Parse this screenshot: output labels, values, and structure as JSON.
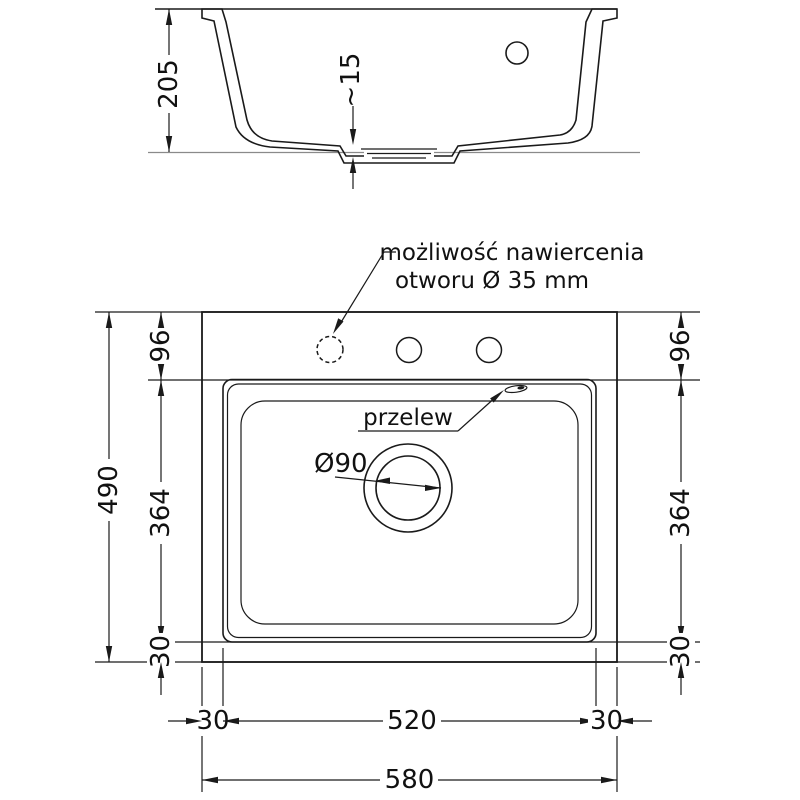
{
  "title": "sink technical drawing",
  "side_view": {
    "total_height": "205",
    "drain_depth": "~15"
  },
  "plan_view": {
    "note_line1": "możliwość nawiercenia",
    "note_line2": "otworu Ø 35 mm",
    "overflow_label": "przelew",
    "drain_diameter": "Ø90",
    "rim_offset_left": "96",
    "rim_offset_right": "96",
    "bowl_length_left": "364",
    "bowl_length_right": "364",
    "bottom_offset_left": "30",
    "bottom_offset_right": "30",
    "overall_depth": "490",
    "margin_left": "30",
    "bowl_width": "520",
    "margin_right": "30",
    "overall_width": "580"
  },
  "colors": {
    "line": "#1a1a1a",
    "background": "#ffffff"
  }
}
